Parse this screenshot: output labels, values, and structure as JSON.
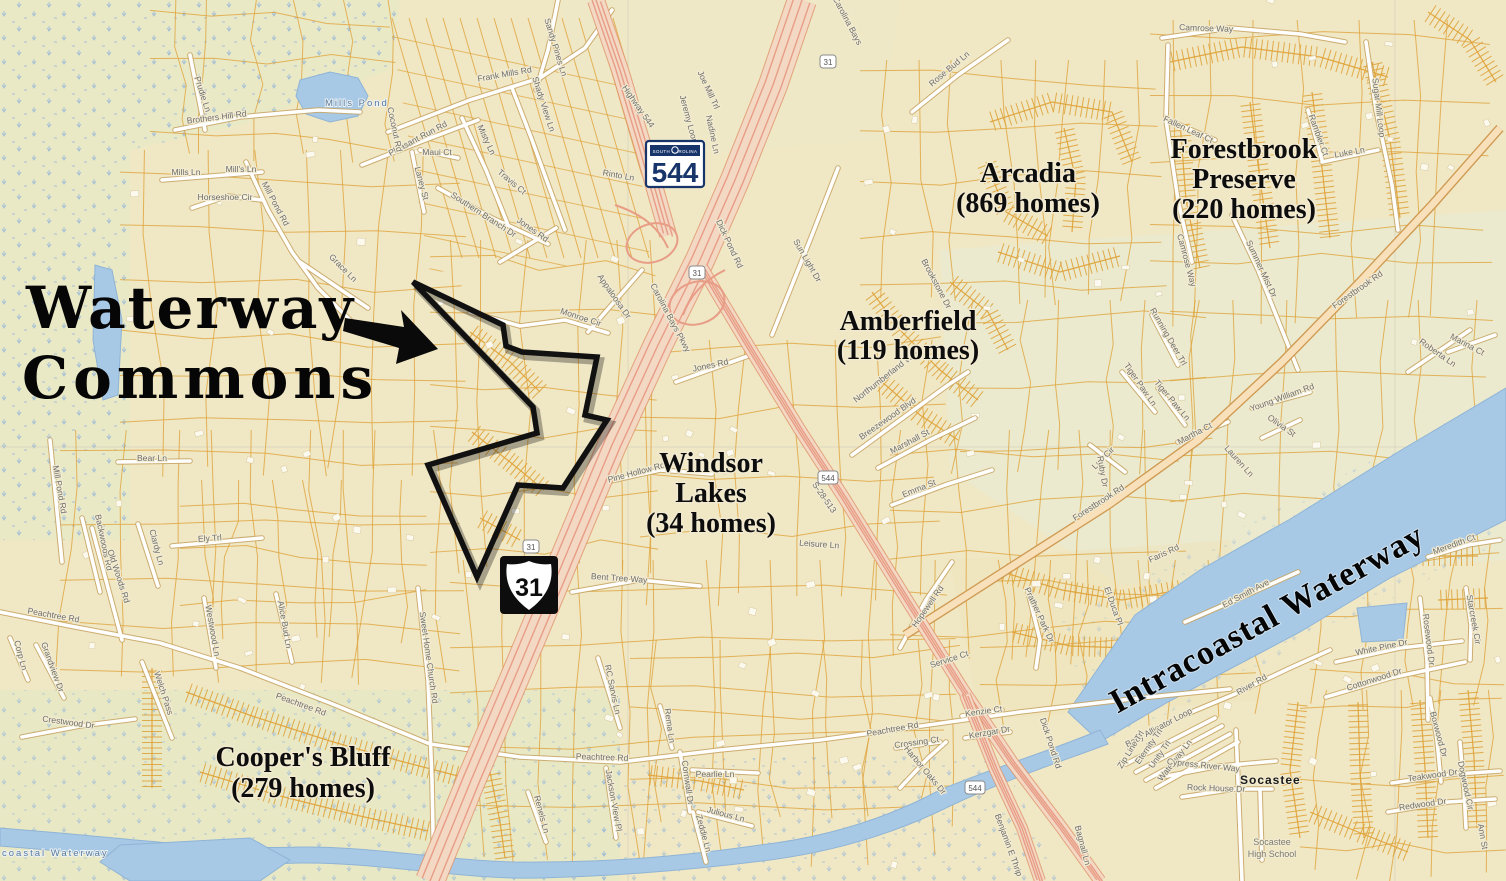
{
  "annotation": {
    "line1": "Waterway",
    "line2": "Commons"
  },
  "neighborhoods": [
    {
      "id": "arcadia",
      "lines": [
        "Arcadia",
        "(869 homes)"
      ],
      "x": 1028,
      "y": 182,
      "lh": 30
    },
    {
      "id": "forestbrook-preserve",
      "lines": [
        "Forestbrook",
        "Preserve",
        "(220 homes)"
      ],
      "x": 1244,
      "y": 158,
      "lh": 30
    },
    {
      "id": "amberfield",
      "lines": [
        "Amberfield",
        "(119 homes)"
      ],
      "x": 908,
      "y": 330,
      "lh": 29
    },
    {
      "id": "windsor-lakes",
      "lines": [
        "Windsor",
        "Lakes",
        "(34 homes)"
      ],
      "x": 711,
      "y": 472,
      "lh": 30
    },
    {
      "id": "coopers-bluff",
      "lines": [
        "Cooper's Bluff",
        "(279 homes)"
      ],
      "x": 303,
      "y": 766,
      "lh": 31
    }
  ],
  "waterway_label": {
    "text": "Intracoastal Waterway",
    "x": 1272,
    "y": 628,
    "rot": -29
  },
  "water_labels": [
    {
      "text": "Mills Pond",
      "x": 325,
      "y": 106,
      "rot": 0
    },
    {
      "text": "coastal Waterway",
      "x": 2,
      "y": 856,
      "rot": 0
    }
  ],
  "place_labels": [
    {
      "text": "Socastee",
      "x": 1240,
      "y": 784,
      "cls": "place"
    },
    {
      "text": "Socastee",
      "x": 1272,
      "y": 845,
      "cls": "place2"
    },
    {
      "text": "High School",
      "x": 1272,
      "y": 857,
      "cls": "place2"
    }
  ],
  "shields": {
    "sc544_large": {
      "state_text": "SOUTH CAROLINA",
      "number": "544",
      "x": 646,
      "y": 141
    },
    "us31_large": {
      "number": "31",
      "x": 500,
      "y": 556
    },
    "small": [
      {
        "number": "31",
        "x": 828,
        "y": 62
      },
      {
        "number": "31",
        "x": 697,
        "y": 273
      },
      {
        "number": "31",
        "x": 531,
        "y": 547
      },
      {
        "number": "544",
        "x": 828,
        "y": 478
      },
      {
        "number": "544",
        "x": 975,
        "y": 788
      }
    ]
  },
  "road_labels": [
    {
      "t": "Prudie Ln",
      "x": 200,
      "y": 95,
      "r": 72
    },
    {
      "t": "Brothers Hill Rd",
      "x": 217,
      "y": 120,
      "r": -7
    },
    {
      "t": "Mills Ln",
      "x": 186,
      "y": 175,
      "r": 0
    },
    {
      "t": "Mill's Ln",
      "x": 241,
      "y": 172,
      "r": 0
    },
    {
      "t": "Horseshoe Cir",
      "x": 225,
      "y": 200,
      "r": 0
    },
    {
      "t": "Mill Pond Rd",
      "x": 273,
      "y": 205,
      "r": 62
    },
    {
      "t": "Grace Ln",
      "x": 341,
      "y": 270,
      "r": 45
    },
    {
      "t": "Sandy Pines Ln",
      "x": 553,
      "y": 48,
      "r": 73
    },
    {
      "t": "Frank Mills Rd",
      "x": 505,
      "y": 77,
      "r": -10
    },
    {
      "t": "Shady View Ln",
      "x": 541,
      "y": 105,
      "r": 72
    },
    {
      "t": "Highway 544",
      "x": 636,
      "y": 108,
      "r": 55
    },
    {
      "t": "Pleasant Run Rd",
      "x": 419,
      "y": 141,
      "r": -28
    },
    {
      "t": "Coconut Rd",
      "x": 392,
      "y": 130,
      "r": 78
    },
    {
      "t": "Maui Ct",
      "x": 437,
      "y": 155,
      "r": 0
    },
    {
      "t": "Laney St",
      "x": 419,
      "y": 184,
      "r": 75
    },
    {
      "t": "Misty Ln",
      "x": 484,
      "y": 141,
      "r": 65
    },
    {
      "t": "Southern Branch Dr",
      "x": 482,
      "y": 217,
      "r": 33
    },
    {
      "t": "Travis Ct",
      "x": 510,
      "y": 184,
      "r": 40
    },
    {
      "t": "Rinto Ln",
      "x": 618,
      "y": 178,
      "r": 10
    },
    {
      "t": "Jones Rd",
      "x": 531,
      "y": 232,
      "r": 35
    },
    {
      "t": "Joe Mill Trl",
      "x": 706,
      "y": 91,
      "r": 65
    },
    {
      "t": "Jeremy Loop",
      "x": 686,
      "y": 120,
      "r": 75
    },
    {
      "t": "Nadine Ln",
      "x": 710,
      "y": 135,
      "r": 78
    },
    {
      "t": "Carolina Bays",
      "x": 845,
      "y": 22,
      "r": 62
    },
    {
      "t": "Rose Bud Ln",
      "x": 951,
      "y": 71,
      "r": -40
    },
    {
      "t": "Dick Pond Rd",
      "x": 727,
      "y": 245,
      "r": 65
    },
    {
      "t": "Sun Light Dr",
      "x": 805,
      "y": 262,
      "r": 60
    },
    {
      "t": "Appaloosa Dr",
      "x": 612,
      "y": 298,
      "r": 55
    },
    {
      "t": "Monroe Cir",
      "x": 580,
      "y": 320,
      "r": 18
    },
    {
      "t": "Carolina Bays Pkwy",
      "x": 668,
      "y": 319,
      "r": 62
    },
    {
      "t": "Jones Rd",
      "x": 711,
      "y": 368,
      "r": -12
    },
    {
      "t": "Pine Hollow Rd",
      "x": 637,
      "y": 475,
      "r": -15
    },
    {
      "t": "Bent Tree Way",
      "x": 619,
      "y": 581,
      "r": 4
    },
    {
      "t": "Bear Ln",
      "x": 152,
      "y": 461,
      "r": 0
    },
    {
      "t": "Mill Pond Rd",
      "x": 57,
      "y": 490,
      "r": 80
    },
    {
      "t": "Northumberland Way",
      "x": 888,
      "y": 378,
      "r": -38
    },
    {
      "t": "Breezewood Blvd",
      "x": 889,
      "y": 421,
      "r": -35
    },
    {
      "t": "Marshall St",
      "x": 911,
      "y": 444,
      "r": -28
    },
    {
      "t": "Emma St",
      "x": 920,
      "y": 491,
      "r": -22
    },
    {
      "t": "Brookstone Dr",
      "x": 934,
      "y": 285,
      "r": 62
    },
    {
      "t": "Hopewell Rd",
      "x": 930,
      "y": 608,
      "r": -55
    },
    {
      "t": "Leisure Ln",
      "x": 819,
      "y": 547,
      "r": 4
    },
    {
      "t": "S-28-513",
      "x": 822,
      "y": 499,
      "r": 55
    },
    {
      "t": "Forestbrook Rd",
      "x": 1100,
      "y": 505,
      "r": -33
    },
    {
      "t": "Forestbrook Rd",
      "x": 1359,
      "y": 292,
      "r": -35
    },
    {
      "t": "Prather Park Dr",
      "x": 1037,
      "y": 616,
      "r": 65
    },
    {
      "t": "Faris Rd",
      "x": 1165,
      "y": 556,
      "r": -25
    },
    {
      "t": "El Duca Pl",
      "x": 1111,
      "y": 607,
      "r": 70
    },
    {
      "t": "Lee Cir",
      "x": 1105,
      "y": 460,
      "r": -45
    },
    {
      "t": "Ruby Dr",
      "x": 1100,
      "y": 472,
      "r": 80
    },
    {
      "t": "Martha Ct",
      "x": 1196,
      "y": 436,
      "r": -28
    },
    {
      "t": "Lauren Ln",
      "x": 1237,
      "y": 463,
      "r": 48
    },
    {
      "t": "Tiger Paw Ln",
      "x": 1138,
      "y": 386,
      "r": 55
    },
    {
      "t": "Tiger Paw Ln",
      "x": 1170,
      "y": 402,
      "r": 50
    },
    {
      "t": "Running Deer Trl",
      "x": 1166,
      "y": 338,
      "r": 60
    },
    {
      "t": "Marina Ct",
      "x": 1466,
      "y": 347,
      "r": 28
    },
    {
      "t": "Roberta Ln",
      "x": 1436,
      "y": 355,
      "r": 35
    },
    {
      "t": "Young William Rd",
      "x": 1283,
      "y": 400,
      "r": -20
    },
    {
      "t": "Olivia St",
      "x": 1280,
      "y": 428,
      "r": 35
    },
    {
      "t": "Camrose Way",
      "x": 1206,
      "y": 31,
      "r": 2
    },
    {
      "t": "Camrose Way",
      "x": 1184,
      "y": 261,
      "r": 75
    },
    {
      "t": "Fallen Leaf Ct",
      "x": 1187,
      "y": 132,
      "r": 25
    },
    {
      "t": "Rambler Ct",
      "x": 1316,
      "y": 136,
      "r": 70
    },
    {
      "t": "Luke Ln",
      "x": 1350,
      "y": 155,
      "r": -10
    },
    {
      "t": "Sugar Mill Loop",
      "x": 1376,
      "y": 108,
      "r": 83
    },
    {
      "t": "Summer Mist Dr",
      "x": 1259,
      "y": 270,
      "r": 65
    },
    {
      "t": "Ed Smith Ave",
      "x": 1247,
      "y": 596,
      "r": -28
    },
    {
      "t": "River Rd",
      "x": 1253,
      "y": 687,
      "r": -30
    },
    {
      "t": "Baby Alligator Loop",
      "x": 1160,
      "y": 730,
      "r": -28
    },
    {
      "t": "Eternity Trl",
      "x": 1151,
      "y": 748,
      "r": -55
    },
    {
      "t": "Unity Trl",
      "x": 1162,
      "y": 756,
      "r": -55
    },
    {
      "t": "Waterway Ln",
      "x": 1177,
      "y": 762,
      "r": -52
    },
    {
      "t": "Zip Line Trl",
      "x": 1133,
      "y": 751,
      "r": -58
    },
    {
      "t": "Cypress River Way",
      "x": 1203,
      "y": 768,
      "r": 6
    },
    {
      "t": "Rock House Dr",
      "x": 1216,
      "y": 791,
      "r": 2
    },
    {
      "t": "White Pine Dr",
      "x": 1382,
      "y": 650,
      "r": -12
    },
    {
      "t": "Cottonwood Dr",
      "x": 1375,
      "y": 682,
      "r": -18
    },
    {
      "t": "Rosewood Dr",
      "x": 1426,
      "y": 640,
      "r": 83
    },
    {
      "t": "Boxwood Dr",
      "x": 1436,
      "y": 735,
      "r": 75
    },
    {
      "t": "Teakwood Dr",
      "x": 1433,
      "y": 778,
      "r": -8
    },
    {
      "t": "Redwood Dr",
      "x": 1423,
      "y": 807,
      "r": -8
    },
    {
      "t": "Dogwood Cir",
      "x": 1463,
      "y": 786,
      "r": 78
    },
    {
      "t": "Meredith Ct",
      "x": 1455,
      "y": 547,
      "r": -20
    },
    {
      "t": "Starcreek Cir",
      "x": 1471,
      "y": 620,
      "r": 80
    },
    {
      "t": "Ann St",
      "x": 1480,
      "y": 837,
      "r": 80
    },
    {
      "t": "Peachtree Rd",
      "x": 53,
      "y": 618,
      "r": 10
    },
    {
      "t": "Peachtree Rd",
      "x": 300,
      "y": 707,
      "r": 20
    },
    {
      "t": "Peachtree Rd",
      "x": 602,
      "y": 760,
      "r": 2
    },
    {
      "t": "Peachtree Rd",
      "x": 893,
      "y": 732,
      "r": -10
    },
    {
      "t": "Ely Trl",
      "x": 210,
      "y": 541,
      "r": -4
    },
    {
      "t": "Backwoods Rd",
      "x": 101,
      "y": 543,
      "r": 78
    },
    {
      "t": "Old Woods Rd",
      "x": 116,
      "y": 577,
      "r": 72
    },
    {
      "t": "Clardy Ln",
      "x": 154,
      "y": 548,
      "r": 75
    },
    {
      "t": "Westwood Ln",
      "x": 210,
      "y": 631,
      "r": 80
    },
    {
      "t": "Alice Bud Ln",
      "x": 282,
      "y": 625,
      "r": 80
    },
    {
      "t": "Corp Ln",
      "x": 18,
      "y": 656,
      "r": 75
    },
    {
      "t": "Grandview Dr",
      "x": 50,
      "y": 668,
      "r": 70
    },
    {
      "t": "Crestwood Dr",
      "x": 68,
      "y": 725,
      "r": 8
    },
    {
      "t": "Welch Pass",
      "x": 161,
      "y": 694,
      "r": 72
    },
    {
      "t": "Sweet Home Church Rd",
      "x": 426,
      "y": 658,
      "r": 82
    },
    {
      "t": "RC Sarvis Ln",
      "x": 610,
      "y": 690,
      "r": 78
    },
    {
      "t": "Rema Ln",
      "x": 667,
      "y": 726,
      "r": 82
    },
    {
      "t": "Jackson View Pl",
      "x": 611,
      "y": 801,
      "r": 80
    },
    {
      "t": "Cornwall Dr",
      "x": 685,
      "y": 783,
      "r": 82
    },
    {
      "t": "Pearlie Ln",
      "x": 715,
      "y": 777,
      "r": 0
    },
    {
      "t": "Julious Ln",
      "x": 725,
      "y": 817,
      "r": 15
    },
    {
      "t": "Zeddie Ln",
      "x": 701,
      "y": 834,
      "r": 75
    },
    {
      "t": "Renels Ln",
      "x": 539,
      "y": 815,
      "r": 75
    },
    {
      "t": "Crossing Ct",
      "x": 917,
      "y": 745,
      "r": -8
    },
    {
      "t": "Harbor Oaks Dr",
      "x": 923,
      "y": 772,
      "r": 50
    },
    {
      "t": "Service Ct",
      "x": 950,
      "y": 662,
      "r": -18
    },
    {
      "t": "Kenzie Ct",
      "x": 984,
      "y": 714,
      "r": -8
    },
    {
      "t": "Kerzgar Dr",
      "x": 990,
      "y": 735,
      "r": -10
    },
    {
      "t": "Dick Pond Rd",
      "x": 1048,
      "y": 744,
      "r": 72
    },
    {
      "t": "Benjamin E Thrip",
      "x": 1006,
      "y": 846,
      "r": 70
    },
    {
      "t": "Bagnall Ln",
      "x": 1080,
      "y": 846,
      "r": 75
    }
  ],
  "colors": {
    "land": "#f0e7c4",
    "water": "#a7c9e5",
    "parcel_line": "#dfa43c",
    "road_casing": "#c8a667",
    "highway_fill": "#f3d8c4",
    "highway_stripe": "#e89d86",
    "label_gray": "#6e6e6e",
    "label_blue": "#567a9b",
    "boundary_black": "#111111",
    "shield_navy": "#17356b"
  }
}
